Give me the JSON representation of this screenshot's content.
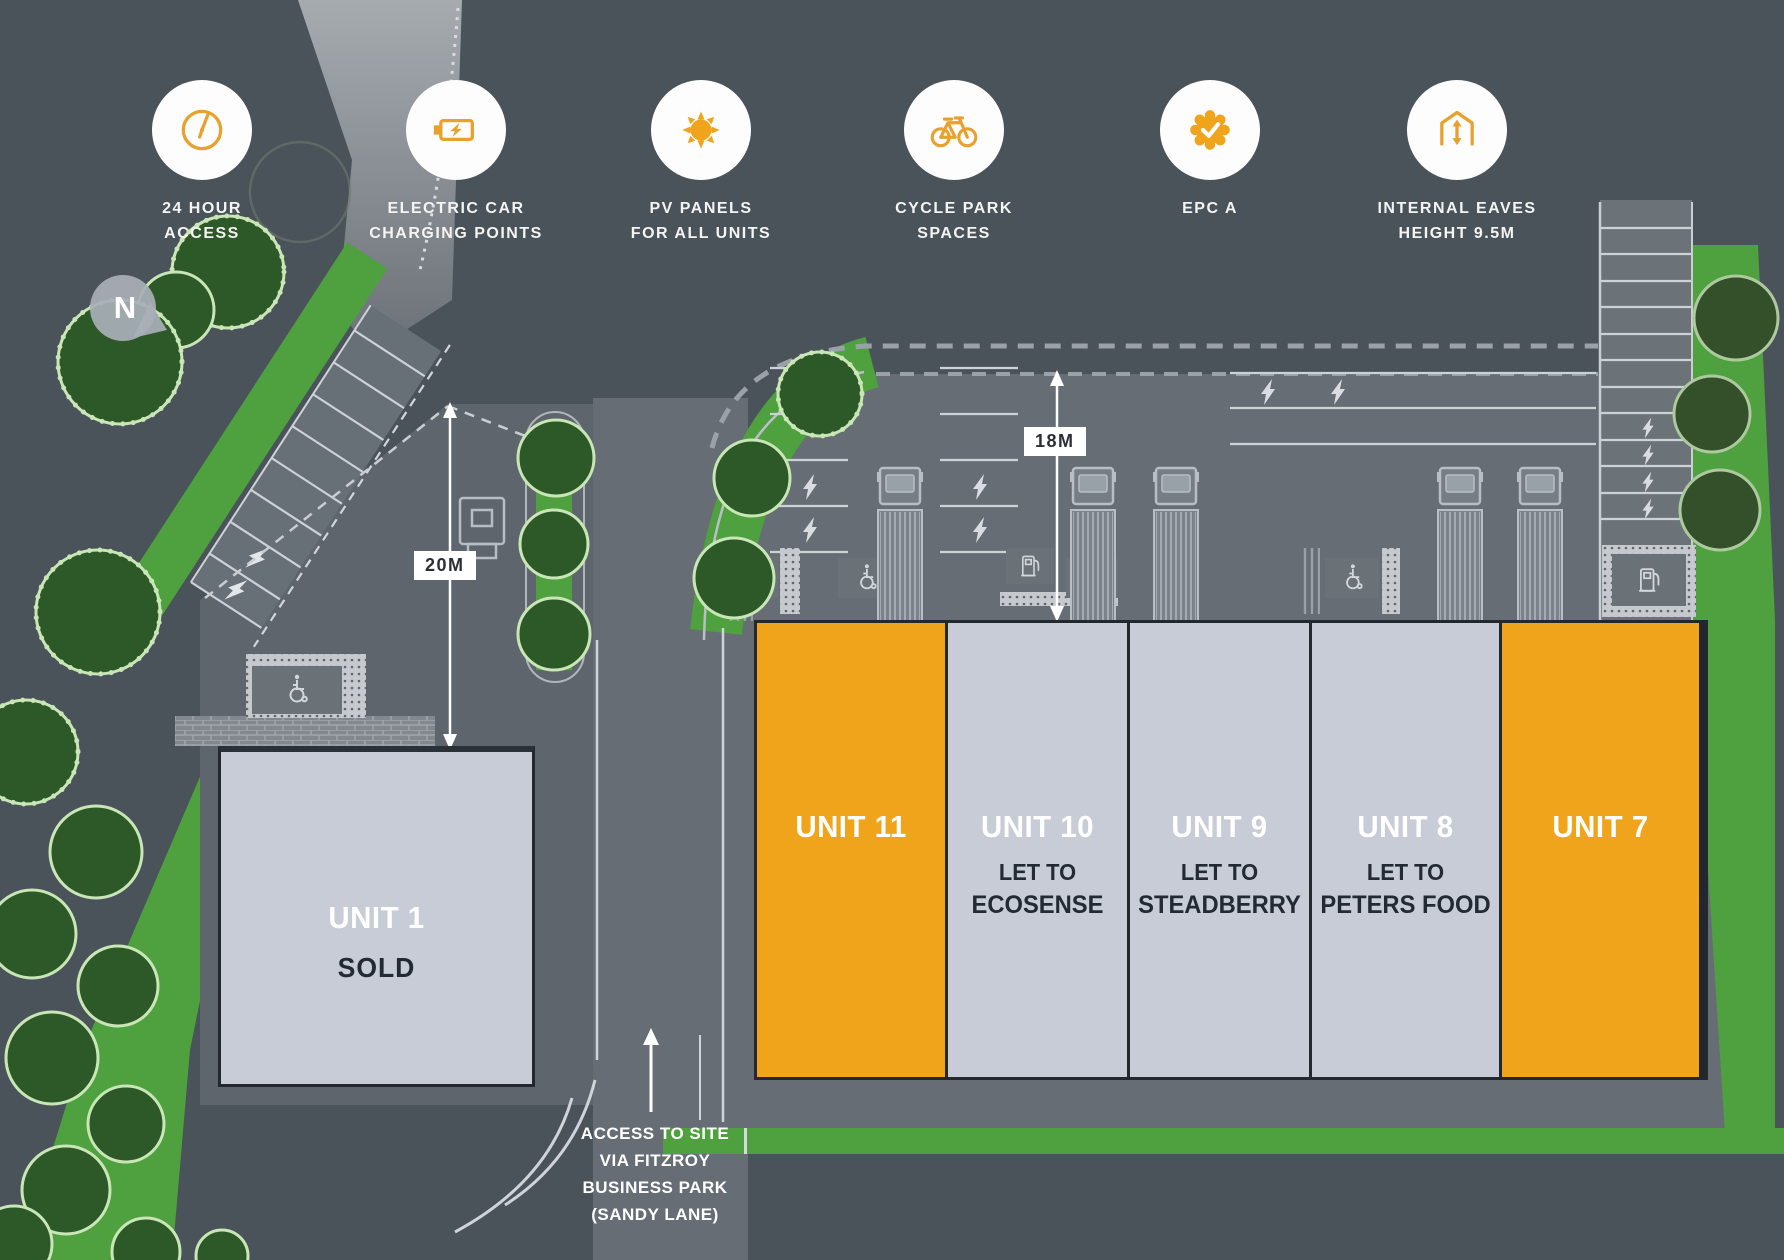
{
  "amenities": [
    {
      "icon": "clock-icon",
      "line1": "24 HOUR",
      "line2": "ACCESS"
    },
    {
      "icon": "battery-icon",
      "line1": "ELECTRIC CAR",
      "line2": "CHARGING POINTS"
    },
    {
      "icon": "sun-icon",
      "line1": "PV PANELS",
      "line2": "FOR ALL UNITS"
    },
    {
      "icon": "bicycle-icon",
      "line1": "CYCLE PARK",
      "line2": "SPACES"
    },
    {
      "icon": "rosette-icon",
      "line1": "EPC A",
      "line2": ""
    },
    {
      "icon": "eaves-icon",
      "line1": "INTERNAL EAVES",
      "line2": "HEIGHT 9.5M"
    }
  ],
  "compass": {
    "label": "N"
  },
  "dimensions": {
    "yard_depth": "18M",
    "side_depth": "20M"
  },
  "access_note": {
    "line1": "ACCESS TO SITE",
    "line2": "VIA FITZROY",
    "line3": "BUSINESS PARK",
    "line4": "(SANDY LANE)"
  },
  "units": {
    "unit1": {
      "name": "UNIT 1",
      "status": "SOLD",
      "state": "sold"
    },
    "unit11": {
      "name": "UNIT 11",
      "state": "available"
    },
    "unit10": {
      "name": "UNIT 10",
      "let_label": "LET TO",
      "tenant": "ECOSENSE",
      "state": "let"
    },
    "unit9": {
      "name": "UNIT 9",
      "let_label": "LET TO",
      "tenant": "STEADBERRY",
      "state": "let"
    },
    "unit8": {
      "name": "UNIT 8",
      "let_label": "LET TO",
      "tenant": "PETERS FOOD",
      "state": "let"
    },
    "unit7": {
      "name": "UNIT 7",
      "state": "available"
    }
  },
  "colors": {
    "accent_orange": "#F0A41C",
    "unit_grey": "#C8CCD6",
    "background": "#4A525A",
    "green": "#4FA03E"
  }
}
